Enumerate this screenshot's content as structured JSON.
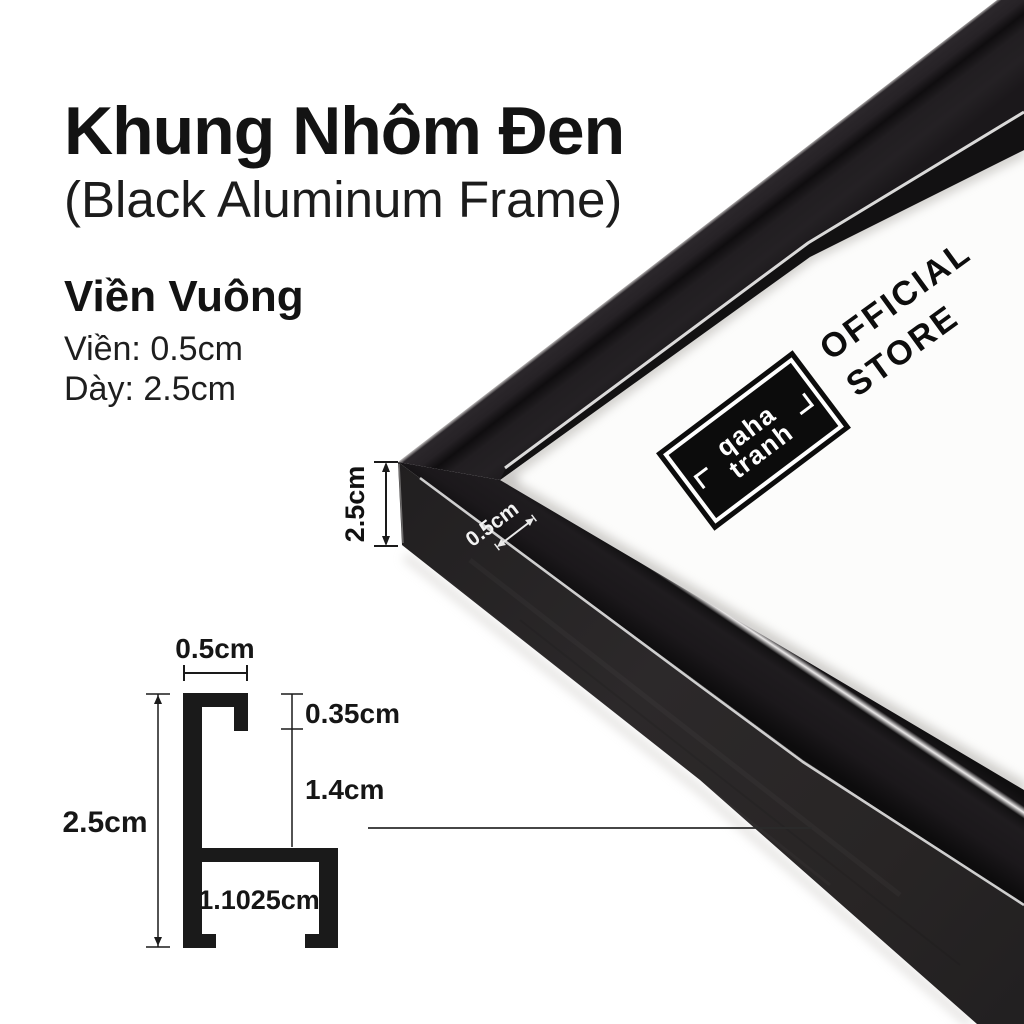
{
  "page": {
    "background": "#ffffff",
    "ink": "#131313"
  },
  "header": {
    "title": "Khung Nhôm Đen",
    "subtitle": "(Black Aluminum Frame)"
  },
  "specs": {
    "heading": "Viền Vuông",
    "border_line": "Viền: 0.5cm",
    "depth_line": "Dày: 2.5cm"
  },
  "photo": {
    "depth_label": "2.5cm",
    "face_label": "0.5cm",
    "frame_color": "#141214",
    "matte_color": "#fcfcfb",
    "stamp": {
      "line1": "qaha",
      "line2": "tranh"
    },
    "store": {
      "line1": "OFFICIAL",
      "line2": "STORE"
    }
  },
  "diagram": {
    "ink": "#1a1a1a",
    "labels": {
      "top_width": "0.5cm",
      "lip_depth": "0.35cm",
      "inner_height": "1.4cm",
      "total_height": "2.5cm",
      "base_width": "1.1025cm"
    }
  }
}
